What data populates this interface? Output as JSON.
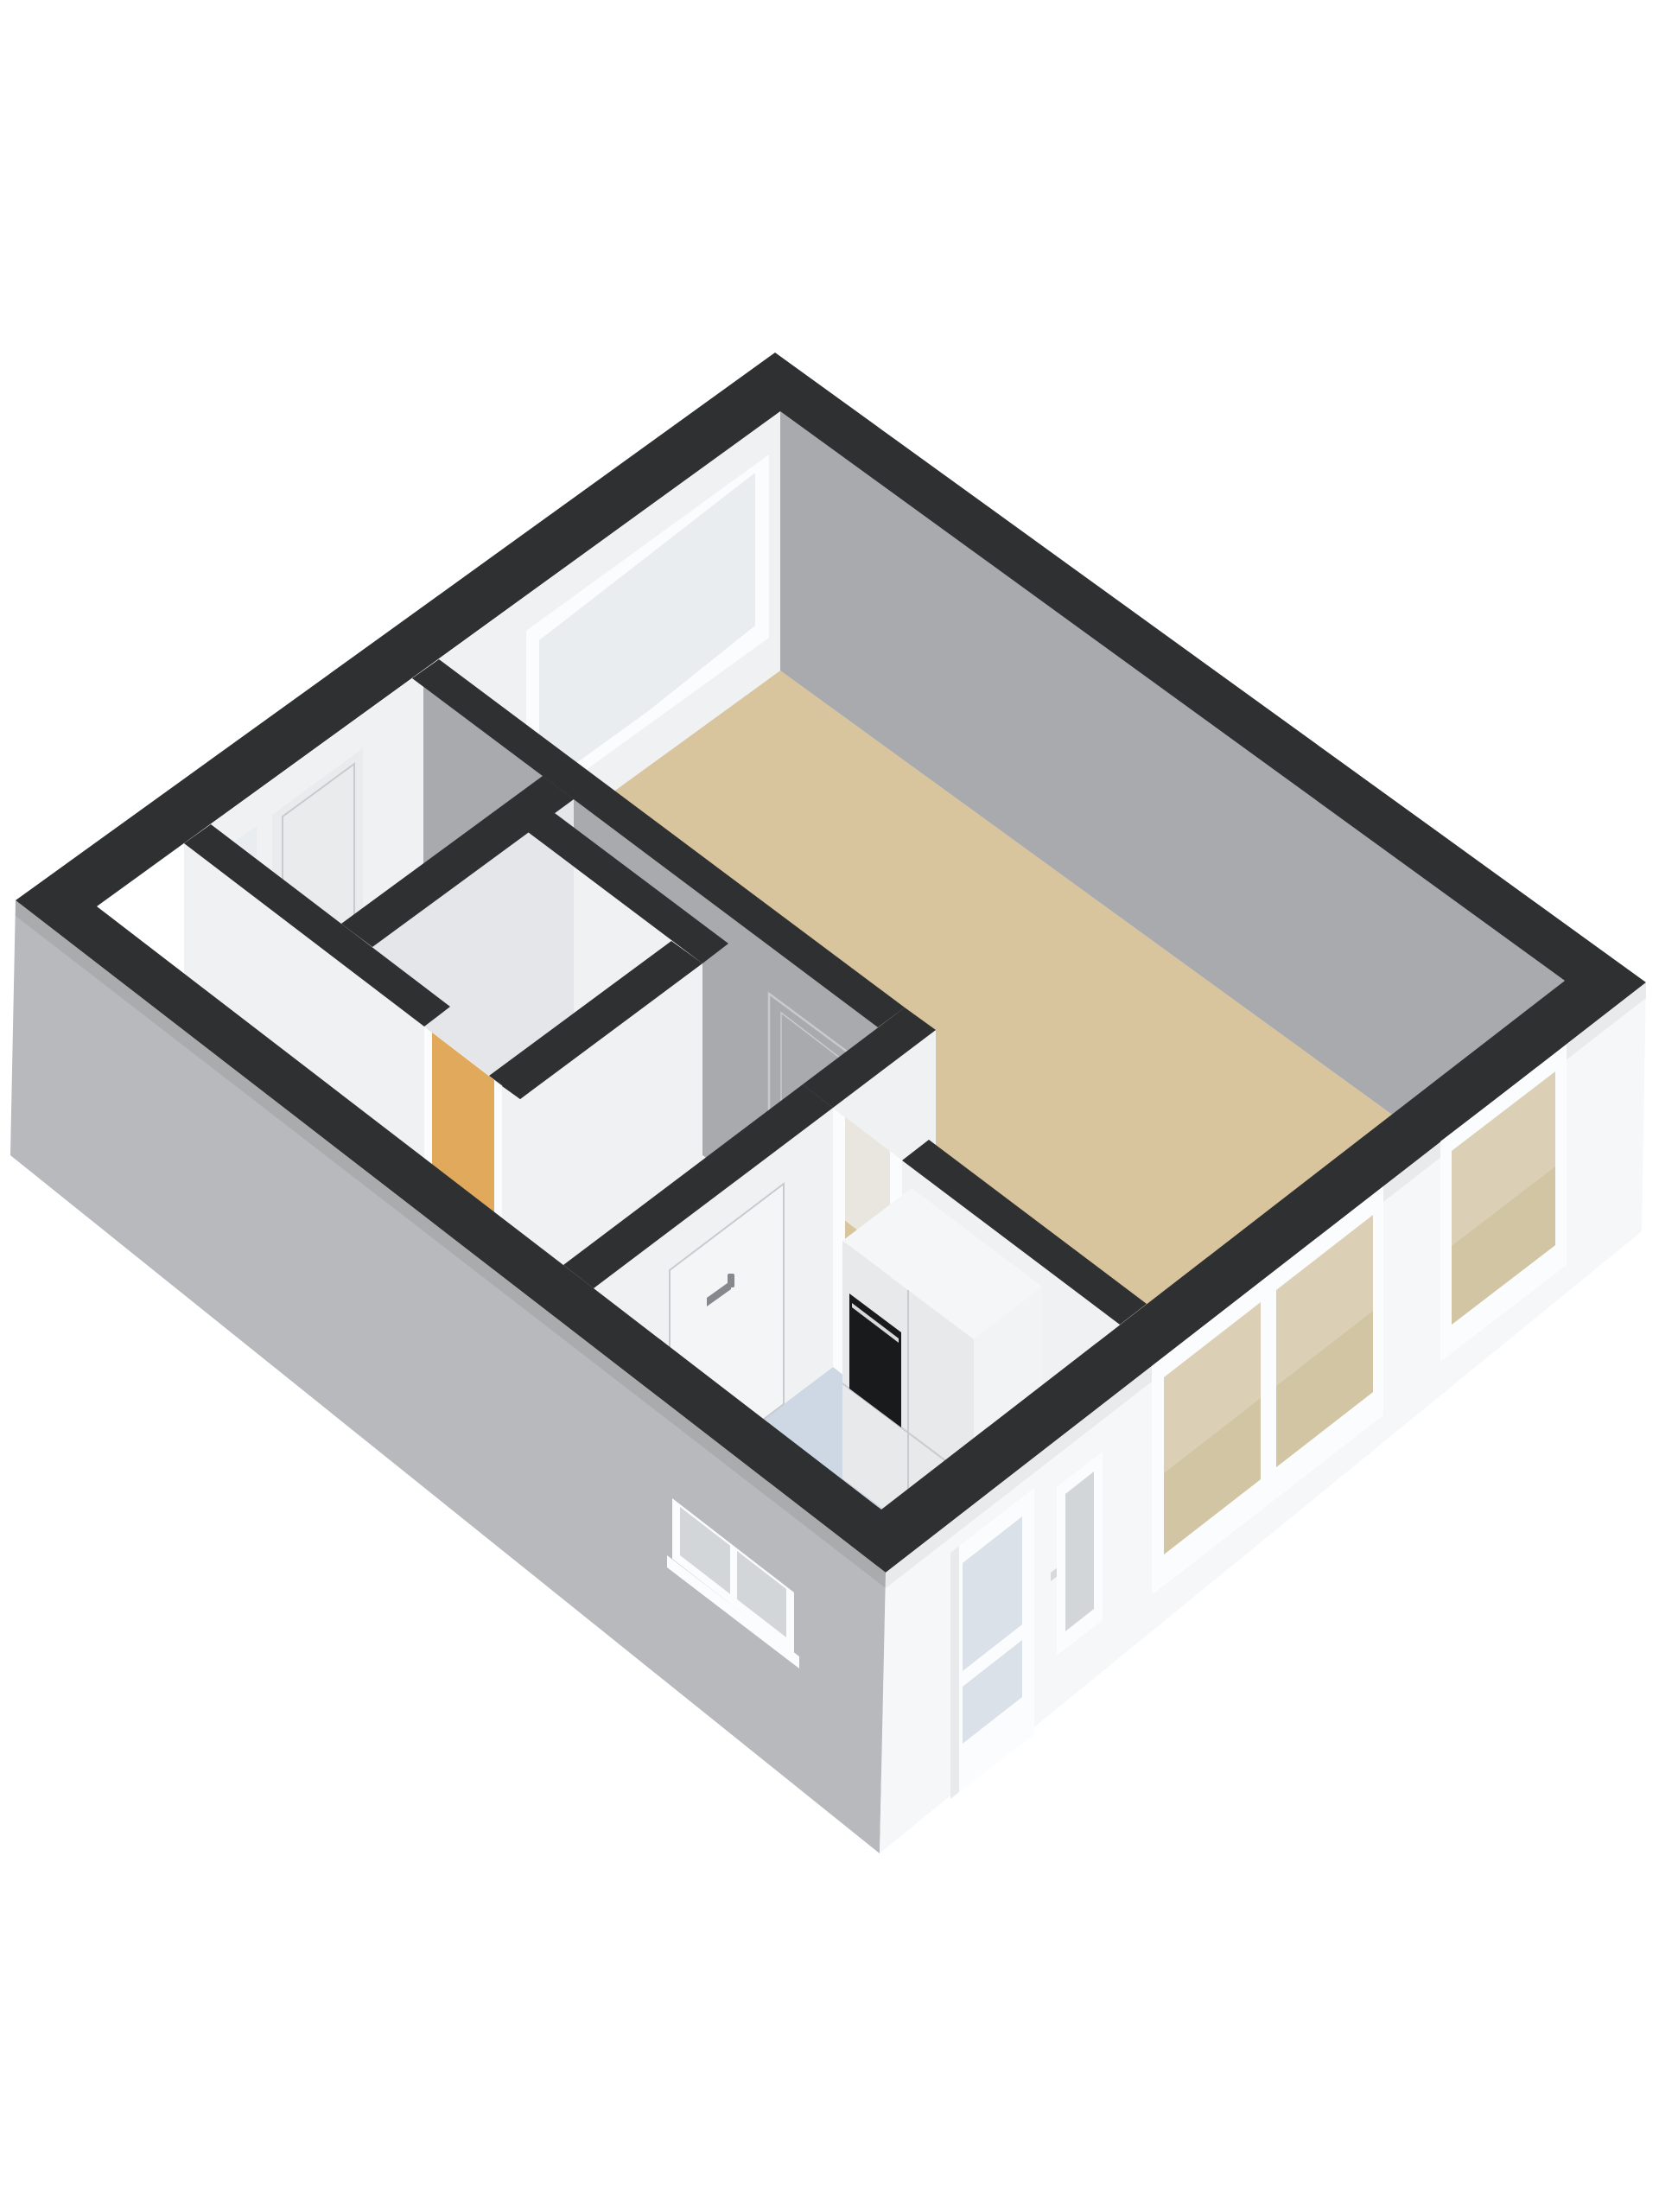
{
  "scene": {
    "type": "3d-floorplan-render",
    "view": "isometric-top",
    "background": "#ffffff"
  },
  "colors": {
    "background": "#ffffff",
    "wallTop": "#2e3032",
    "facadeSide": "#b7b9bc",
    "facadeSideShade": "#a9abad",
    "facadeFront": "#f6f7f8",
    "facadeFrontShade": "#e8eaec",
    "interiorGrey": "#a8aaae",
    "interiorWhite": "#eff1f3",
    "interiorWhiteShade": "#e4e6e9",
    "floorLiving": "#d8c49d",
    "floorHall": "#f2f3f5",
    "floorToilet": "#e0a95c",
    "floorKitchen": "#cdd8e4",
    "windowFrame": "#fbfcfd",
    "windowGlass": "#e9edf0",
    "glassBeige": "#dbd0b6",
    "glassBeigeDark": "#d2c5a4",
    "glassGreyBlue": "#d2d6d9",
    "glassBlue": "#dbe1e9",
    "cabinetTop": "#f5f6f8",
    "cabinetFront": "#e7e9eb",
    "cabinetSide": "#f2f3f5",
    "oven": "#191a1c",
    "seam": "#c8cacd",
    "handleGrey": "#85888c",
    "handleLight": "#d7d9db",
    "doorWhite": "#f4f5f7",
    "doorShade": "#e9ebed",
    "gapUpper": "#e9e6df"
  }
}
